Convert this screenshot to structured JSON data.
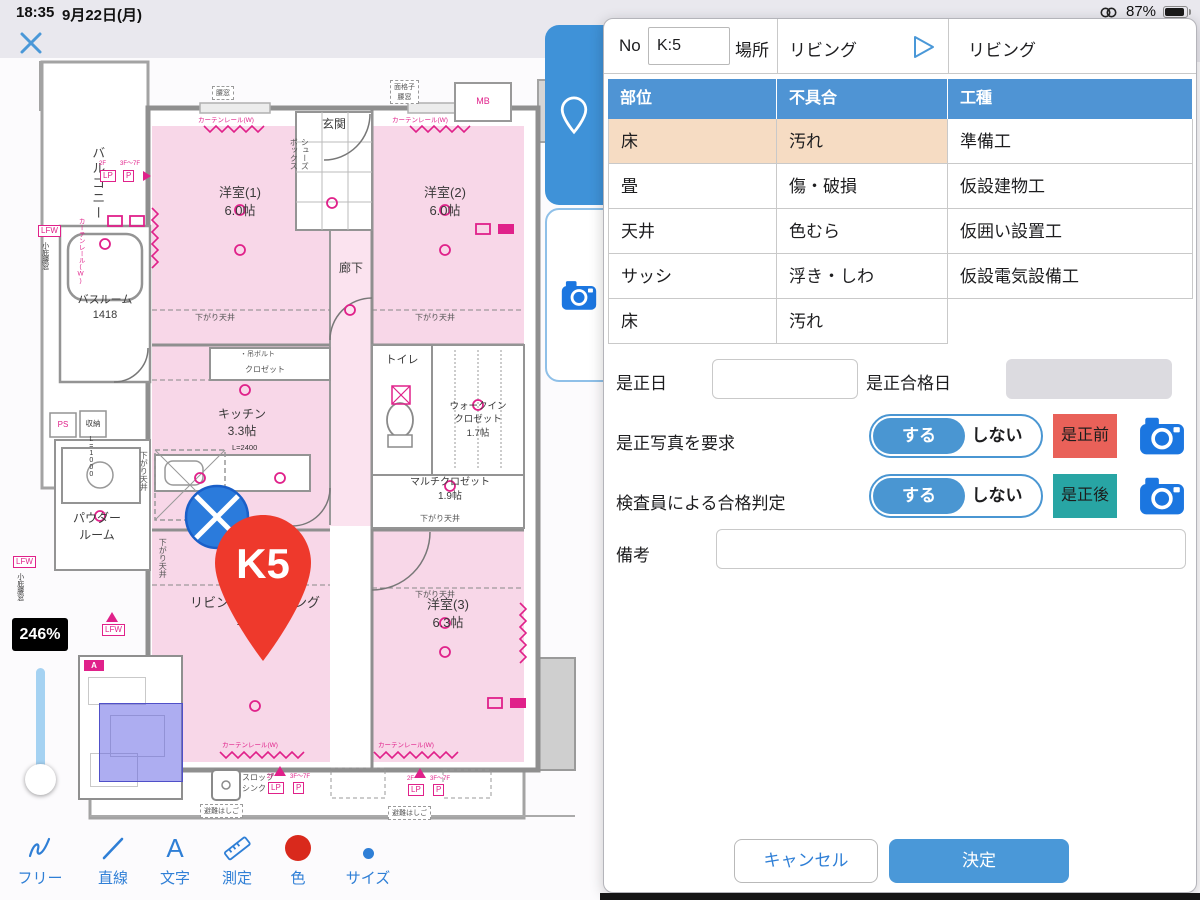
{
  "colors": {
    "accent_blue": "#3f92d8",
    "table_header_blue": "#4f94d4",
    "selected_row_peach": "#f6dcc3",
    "before_button_red": "#e96159",
    "after_button_teal": "#28a5a4",
    "camera_blue": "#1b76e0",
    "pin_red": "#ee392c",
    "plan_pink": "#f8d7e8",
    "plan_magenta": "#e0218a",
    "toolbar_red": "#d9291c"
  },
  "status_bar": {
    "time": "18:35",
    "date": "9月22日(月)",
    "battery": "87%"
  },
  "canvas": {
    "zoom_badge": "246%",
    "marker_label": "K5",
    "minimap_a": "A",
    "toolbar": {
      "free": "フリー",
      "line": "直線",
      "text": "文字",
      "text_icon": "A",
      "measure": "測定",
      "color": "色",
      "size": "サイズ"
    },
    "plan": {
      "balcony": "バルコニー",
      "room1": "洋室(1)\n6.0帖",
      "room2": "洋室(2)\n6.0帖",
      "room3": "洋室(3)\n6.3帖",
      "entrance": "玄関",
      "shoes_box": "シューズ\nボックス",
      "corridor": "廊下",
      "bathroom": "バスルーム\n1418",
      "toilet": "トイレ",
      "kitchen": "キッチン\n3.3帖",
      "walk_in_closet": "ウォークイン\nクロゼット\n1.7帖",
      "multi_closet": "マルチクロゼット\n1.9帖",
      "powder_room": "パウダー\nルーム",
      "living_dining": "リビング・ダイニング\n11.9帖",
      "slop_sink": "スロップ\nシンク",
      "lowered_ceiling": "下がり天井",
      "closet": "クロゼット",
      "hanging_bolt": "・吊ボルト",
      "curtain_rail": "カーテンレール(W)",
      "mb": "MB",
      "ps": "PS",
      "storage": "収納",
      "lp": "LP",
      "p": "P",
      "lfw": "LFW",
      "small_window": "小庇腰窓",
      "koshimado": "腰窓",
      "menkoshi": "面格子\n腰窓",
      "l2400": "L=2400",
      "l1000": "L=1000",
      "escape_hatch": "避難はしご",
      "floor_2f": "2F",
      "floor_3_7f": "3F〜7F"
    }
  },
  "panel": {
    "no_label": "No",
    "no_value": "K:5",
    "place_label": "場所",
    "place_value": "リビング",
    "place_value_right": "リビング",
    "table": {
      "headers": [
        "部位",
        "不具合",
        "工種"
      ],
      "rows": [
        [
          "床",
          "汚れ",
          "準備工"
        ],
        [
          "畳",
          "傷・破損",
          "仮設建物工"
        ],
        [
          "天井",
          "色むら",
          "仮囲い設置工"
        ],
        [
          "サッシ",
          "浮き・しわ",
          "仮設電気設備工"
        ],
        [
          "床",
          "汚れ",
          ""
        ]
      ]
    },
    "correction_date_label": "是正日",
    "correction_pass_date_label": "是正合格日",
    "photo_request_label": "是正写真を要求",
    "judgement_label": "検査員による合格判定",
    "toggle_on": "する",
    "toggle_off": "しない",
    "before_correction": "是正前",
    "after_correction": "是正後",
    "remarks_label": "備考",
    "cancel": "キャンセル",
    "confirm": "決定"
  }
}
